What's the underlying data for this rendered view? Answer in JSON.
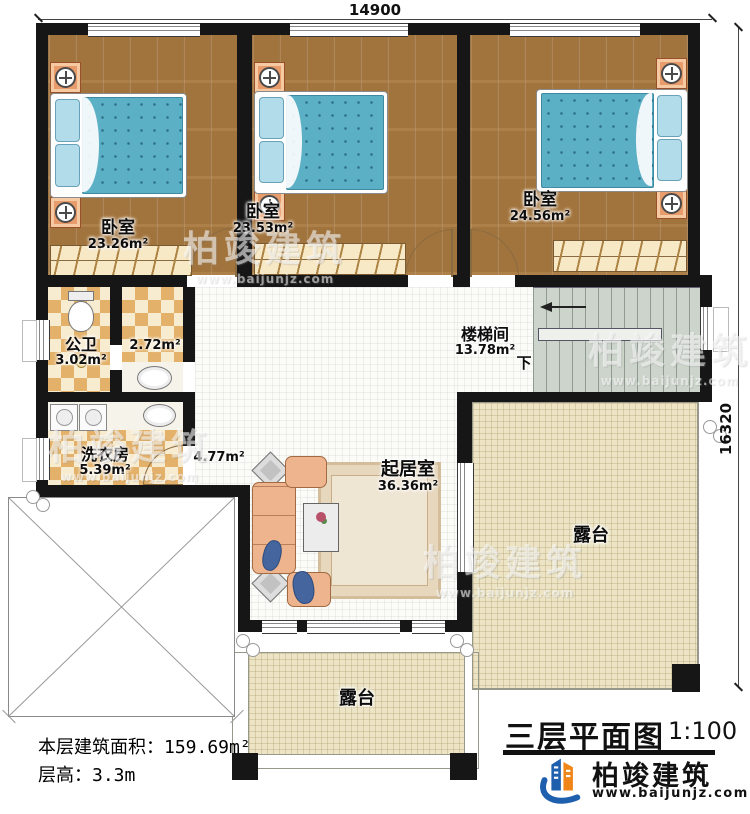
{
  "dimensions": {
    "top": "14900",
    "right": "16320"
  },
  "rooms": {
    "bedroom1": {
      "name": "卧室",
      "area": "23.26m²"
    },
    "bedroom2": {
      "name": "卧室",
      "area": "23.53m²"
    },
    "bedroom3": {
      "name": "卧室",
      "area": "24.56m²"
    },
    "bathroom": {
      "name": "公卫",
      "area": "3.02m²"
    },
    "vanity": {
      "area": "2.72m²"
    },
    "laundry": {
      "name": "洗衣房",
      "area": "5.39m²"
    },
    "hallway": {
      "area": "4.77m²"
    },
    "stairwell": {
      "name": "楼梯间",
      "area": "13.78m²",
      "down": "下"
    },
    "living": {
      "name": "起居室",
      "area": "36.36m²"
    },
    "terraceRight": {
      "name": "露台"
    },
    "terraceBottom": {
      "name": "露台"
    }
  },
  "info": {
    "areaLabel": "本层建筑面积：",
    "areaValue": "159.69m²",
    "heightLabel": "层高：",
    "heightValue": "3.3m"
  },
  "titleBlock": {
    "title": "三层平面图",
    "scale": "1:100"
  },
  "brand": {
    "name": "柏竣建筑",
    "site": "www.baijunjz.com"
  },
  "watermark": {
    "name": "柏竣建筑",
    "site": "www.baijunjz.com"
  }
}
